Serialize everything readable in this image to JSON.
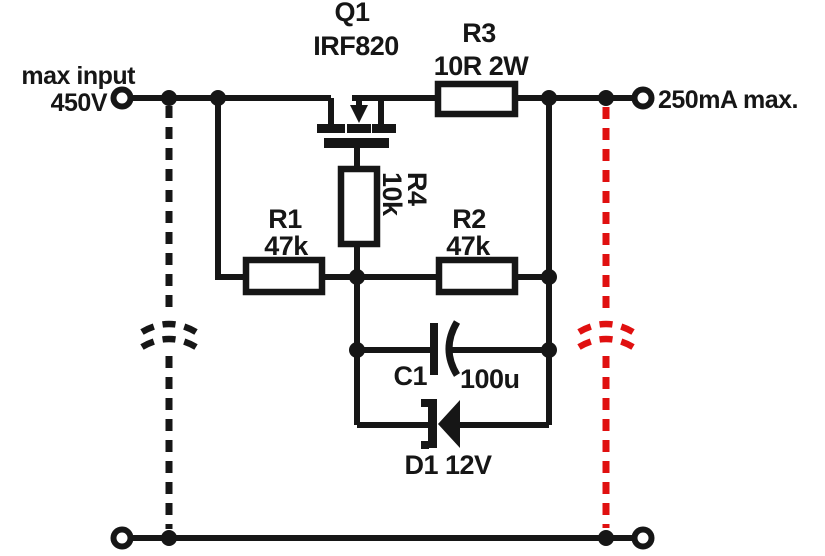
{
  "diagram": {
    "kind": "analog circuit schematic",
    "description": "High-voltage MOSFET current limiter"
  },
  "colors": {
    "ink": "#161616",
    "highlight": "#e01010",
    "background": "#ffffff"
  },
  "schematic": {
    "input_terminal": {
      "label_line1": "max input",
      "label_line2": "450V"
    },
    "output_terminal": {
      "label": "250mA max."
    },
    "transistor_q1": {
      "ref": "Q1",
      "part": "IRF820"
    },
    "resistor_r3": {
      "ref": "R3",
      "value": "10R 2W"
    },
    "resistor_r1": {
      "ref": "R1",
      "value": "47k"
    },
    "resistor_r2": {
      "ref": "R2",
      "value": "47k"
    },
    "resistor_r4": {
      "ref": "R4",
      "value": "10k"
    },
    "capacitor_c1": {
      "ref": "C1",
      "value": "100u"
    },
    "zener_d1": {
      "label": "D1 12V"
    }
  }
}
